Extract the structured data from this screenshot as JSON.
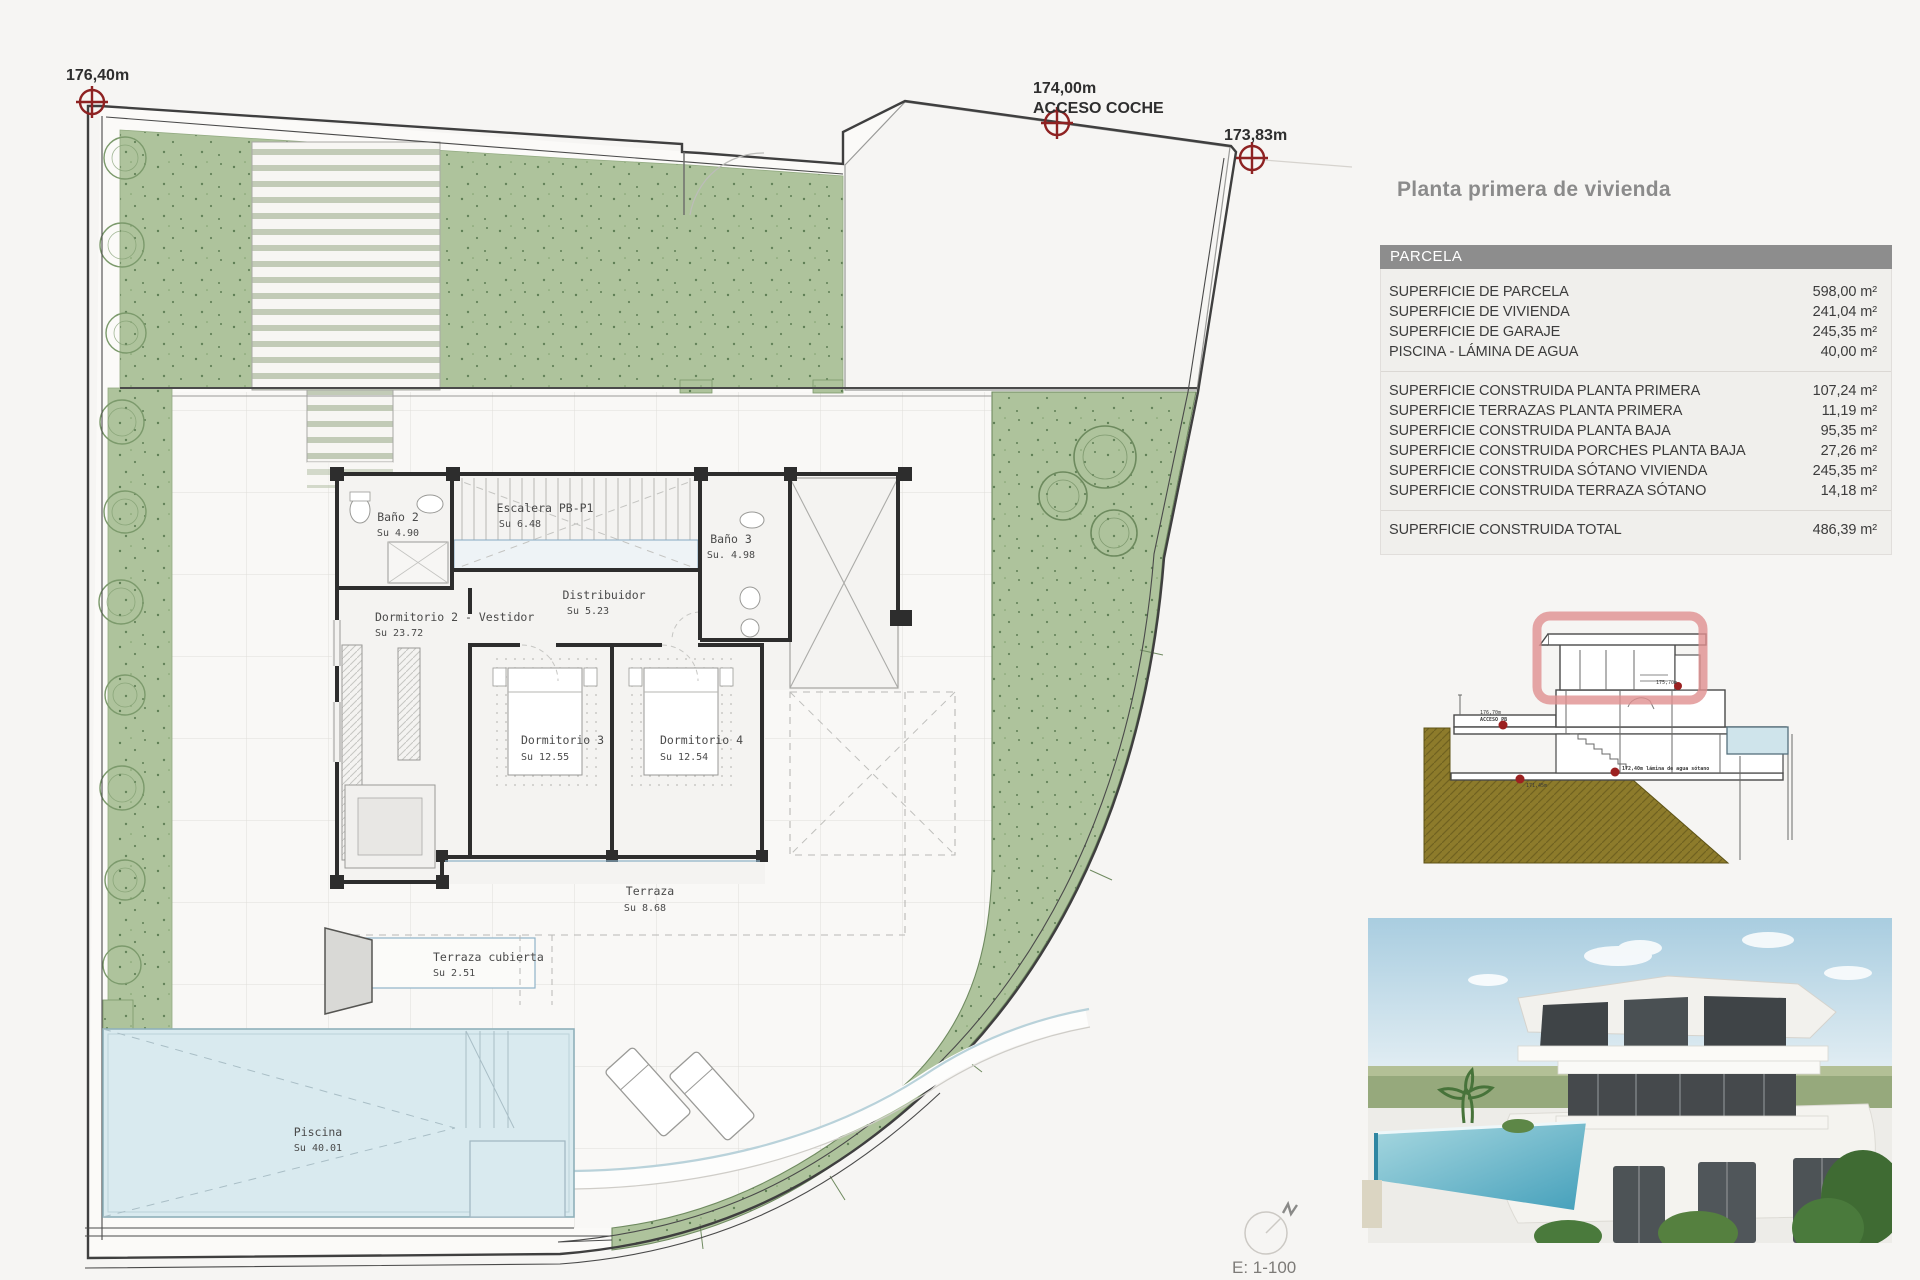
{
  "panel": {
    "title": "Planta primera de vivienda",
    "table": {
      "header": "PARCELA",
      "groups": [
        {
          "rows": [
            {
              "label": "SUPERFICIE DE PARCELA",
              "value": "598,00 m²"
            },
            {
              "label": "SUPERFICIE DE VIVIENDA",
              "value": "241,04 m²"
            },
            {
              "label": "SUPERFICIE DE GARAJE",
              "value": "245,35 m²"
            },
            {
              "label": "PISCINA - LÁMINA DE AGUA",
              "value": "40,00 m²"
            }
          ]
        },
        {
          "rows": [
            {
              "label": "SUPERFICIE CONSTRUIDA PLANTA PRIMERA",
              "value": "107,24 m²"
            },
            {
              "label": "SUPERFICIE TERRAZAS PLANTA PRIMERA",
              "value": "11,19 m²"
            },
            {
              "label": "SUPERFICIE CONSTRUIDA PLANTA BAJA",
              "value": "95,35 m²"
            },
            {
              "label": "SUPERFICIE CONSTRUIDA PORCHES PLANTA BAJA",
              "value": "27,26 m²"
            },
            {
              "label": "SUPERFICIE CONSTRUIDA SÓTANO VIVIENDA",
              "value": "245,35 m²"
            },
            {
              "label": "SUPERFICIE CONSTRUIDA TERRAZA SÓTANO",
              "value": "14,18 m²"
            }
          ]
        },
        {
          "rows": [
            {
              "label": "SUPERFICIE CONSTRUIDA TOTAL",
              "value": "486,39 m²"
            }
          ]
        }
      ]
    },
    "section": {
      "labels": {
        "m1a": "176,70m",
        "m1b": "ACCESO PB",
        "m2": "172,40m lámina de agua sótano",
        "m3": "171,45m",
        "m4": "175,70m"
      }
    }
  },
  "plan": {
    "markers": [
      {
        "label": "176,40m",
        "sublabel": ""
      },
      {
        "label": "174,00m",
        "sublabel": "ACCESO COCHE"
      },
      {
        "label": "173,83m",
        "sublabel": ""
      }
    ],
    "rooms": [
      {
        "name": "Baño 2",
        "area": "Su 4.90"
      },
      {
        "name": "Escalera PB-P1",
        "area": "Su 6.48"
      },
      {
        "name": "Baño 3",
        "area": "Su. 4.98"
      },
      {
        "name": "Distribuidor",
        "area": "Su 5.23"
      },
      {
        "name": "Dormitorio 2 - Vestidor",
        "area": "Su 23.72"
      },
      {
        "name": "Dormitorio 3",
        "area": "Su 12.55"
      },
      {
        "name": "Dormitorio 4",
        "area": "Su 12.54"
      },
      {
        "name": "Terraza",
        "area": "Su 8.68"
      },
      {
        "name": "Terraza cubierta",
        "area": "Su 2.51"
      },
      {
        "name": "Piscina",
        "area": "Su 40.01"
      }
    ],
    "scale_label": "E: 1-100",
    "north_label": "N",
    "colors": {
      "garden": "#aec39c",
      "pool": "#d9eaef",
      "boundary": "#3f3f3f",
      "walls": "#2d2d2d",
      "marker_red": "#8e2222",
      "highlight_red": "#e09090",
      "ground_olive": "#8d7b2b",
      "table_header": "#8d8d8d",
      "table_body": "#f0efec"
    }
  }
}
